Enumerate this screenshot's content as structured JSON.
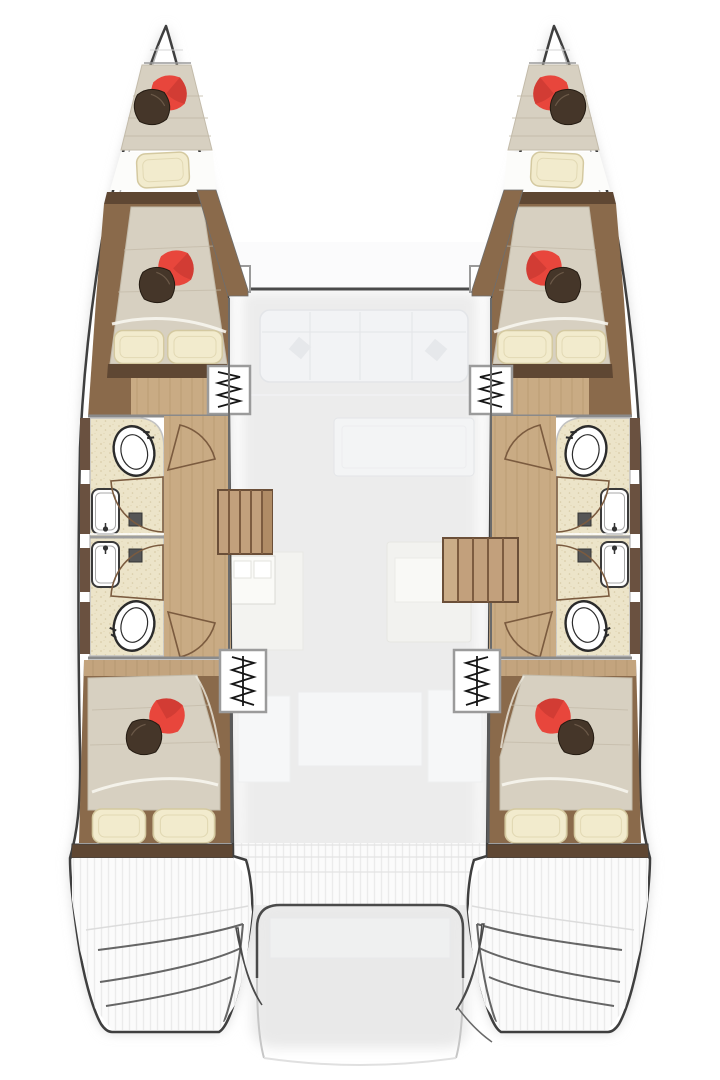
{
  "figure": {
    "kind": "Catamaran yacht interior layout — top-down floor plan",
    "hulls": 2,
    "double_cabins": 4,
    "bow_berths": 2,
    "bathrooms": 4,
    "companionway_ladders": 4,
    "stair_flights": 2
  },
  "colors": {
    "hull_outline": "#3f3f3f",
    "wall_gray": "#8a8a8a",
    "wood_dark": "#5f4733",
    "wood_mid": "#8a6a4b",
    "wood_trim": "#6a5140",
    "wood_floor": "#c9ab84",
    "wood_plank_line": "#b4936c",
    "stair_wood": "#c2a07c",
    "stair_edge": "#6b4f38",
    "stair_line": "#7d5c40",
    "bathroom_floor": "#ece4c9",
    "speckle": "#d9cda8",
    "mattress": "#d7d0c1",
    "mattress_line": "#c2b9a7",
    "sheet_white": "#f7f5ee",
    "pillow_cream": "#f2ebcd",
    "pillow_cream_edge": "#d4c9a0",
    "pillow_red": "#e8463c",
    "pillow_red_dark": "#bf342e",
    "pillow_dark": "#453629",
    "fixture_stroke": "#2b2b2b",
    "fan_stroke": "#7b5b3f",
    "ghost_fill": "#f2f3f5",
    "ghost_edge": "#e3e5e8",
    "deck_hatch": "#ebebeb",
    "shadow": "#d6d6d6",
    "white": "#ffffff"
  },
  "symbols": {
    "toilet": "black-outlined oval bowl",
    "sink": "white rounded basin with faucet",
    "shower_drain": "small dark square",
    "door_swing": "quarter-circle fan arc",
    "companionway_ladder": "white box with zigzag rungs",
    "stairs": "wood tread flight",
    "bed_pillows": "red and dark diamond pillows with cream pillows"
  }
}
